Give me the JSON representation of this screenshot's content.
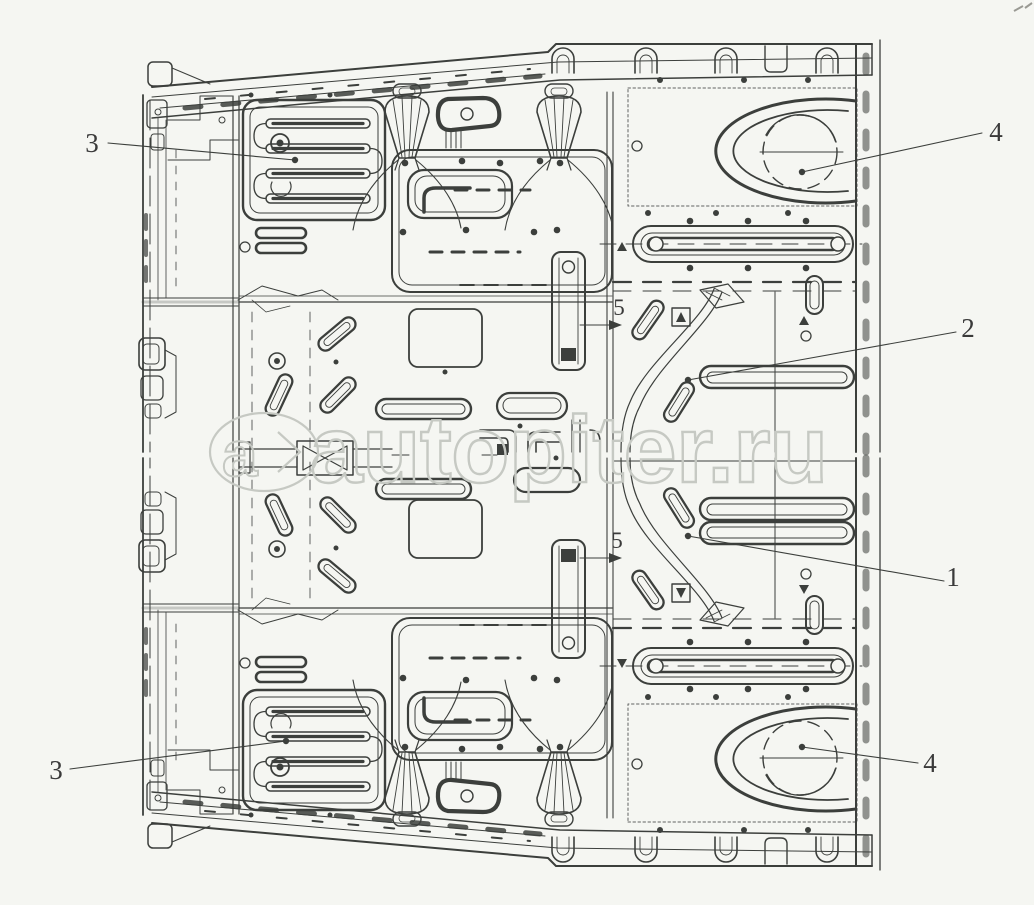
{
  "figure": {
    "type": "exploded-parts-line-drawing",
    "subject": "Cab floor panel assembly engineering diagram",
    "background_color": "#f5f6f2",
    "line_color": "#3c3f3c"
  },
  "callouts": {
    "c3_top": {
      "label": "3"
    },
    "c4_top": {
      "label": "4"
    },
    "c2": {
      "label": "2"
    },
    "c5_upper": {
      "label": "5"
    },
    "c5_lower": {
      "label": "5"
    },
    "c1": {
      "label": "1"
    },
    "c3_bottom": {
      "label": "3"
    },
    "c4_bottom": {
      "label": "4"
    }
  },
  "watermark": {
    "logo_letter": "a",
    "text": "autopiter.ru",
    "color": "#c6c9c3"
  }
}
